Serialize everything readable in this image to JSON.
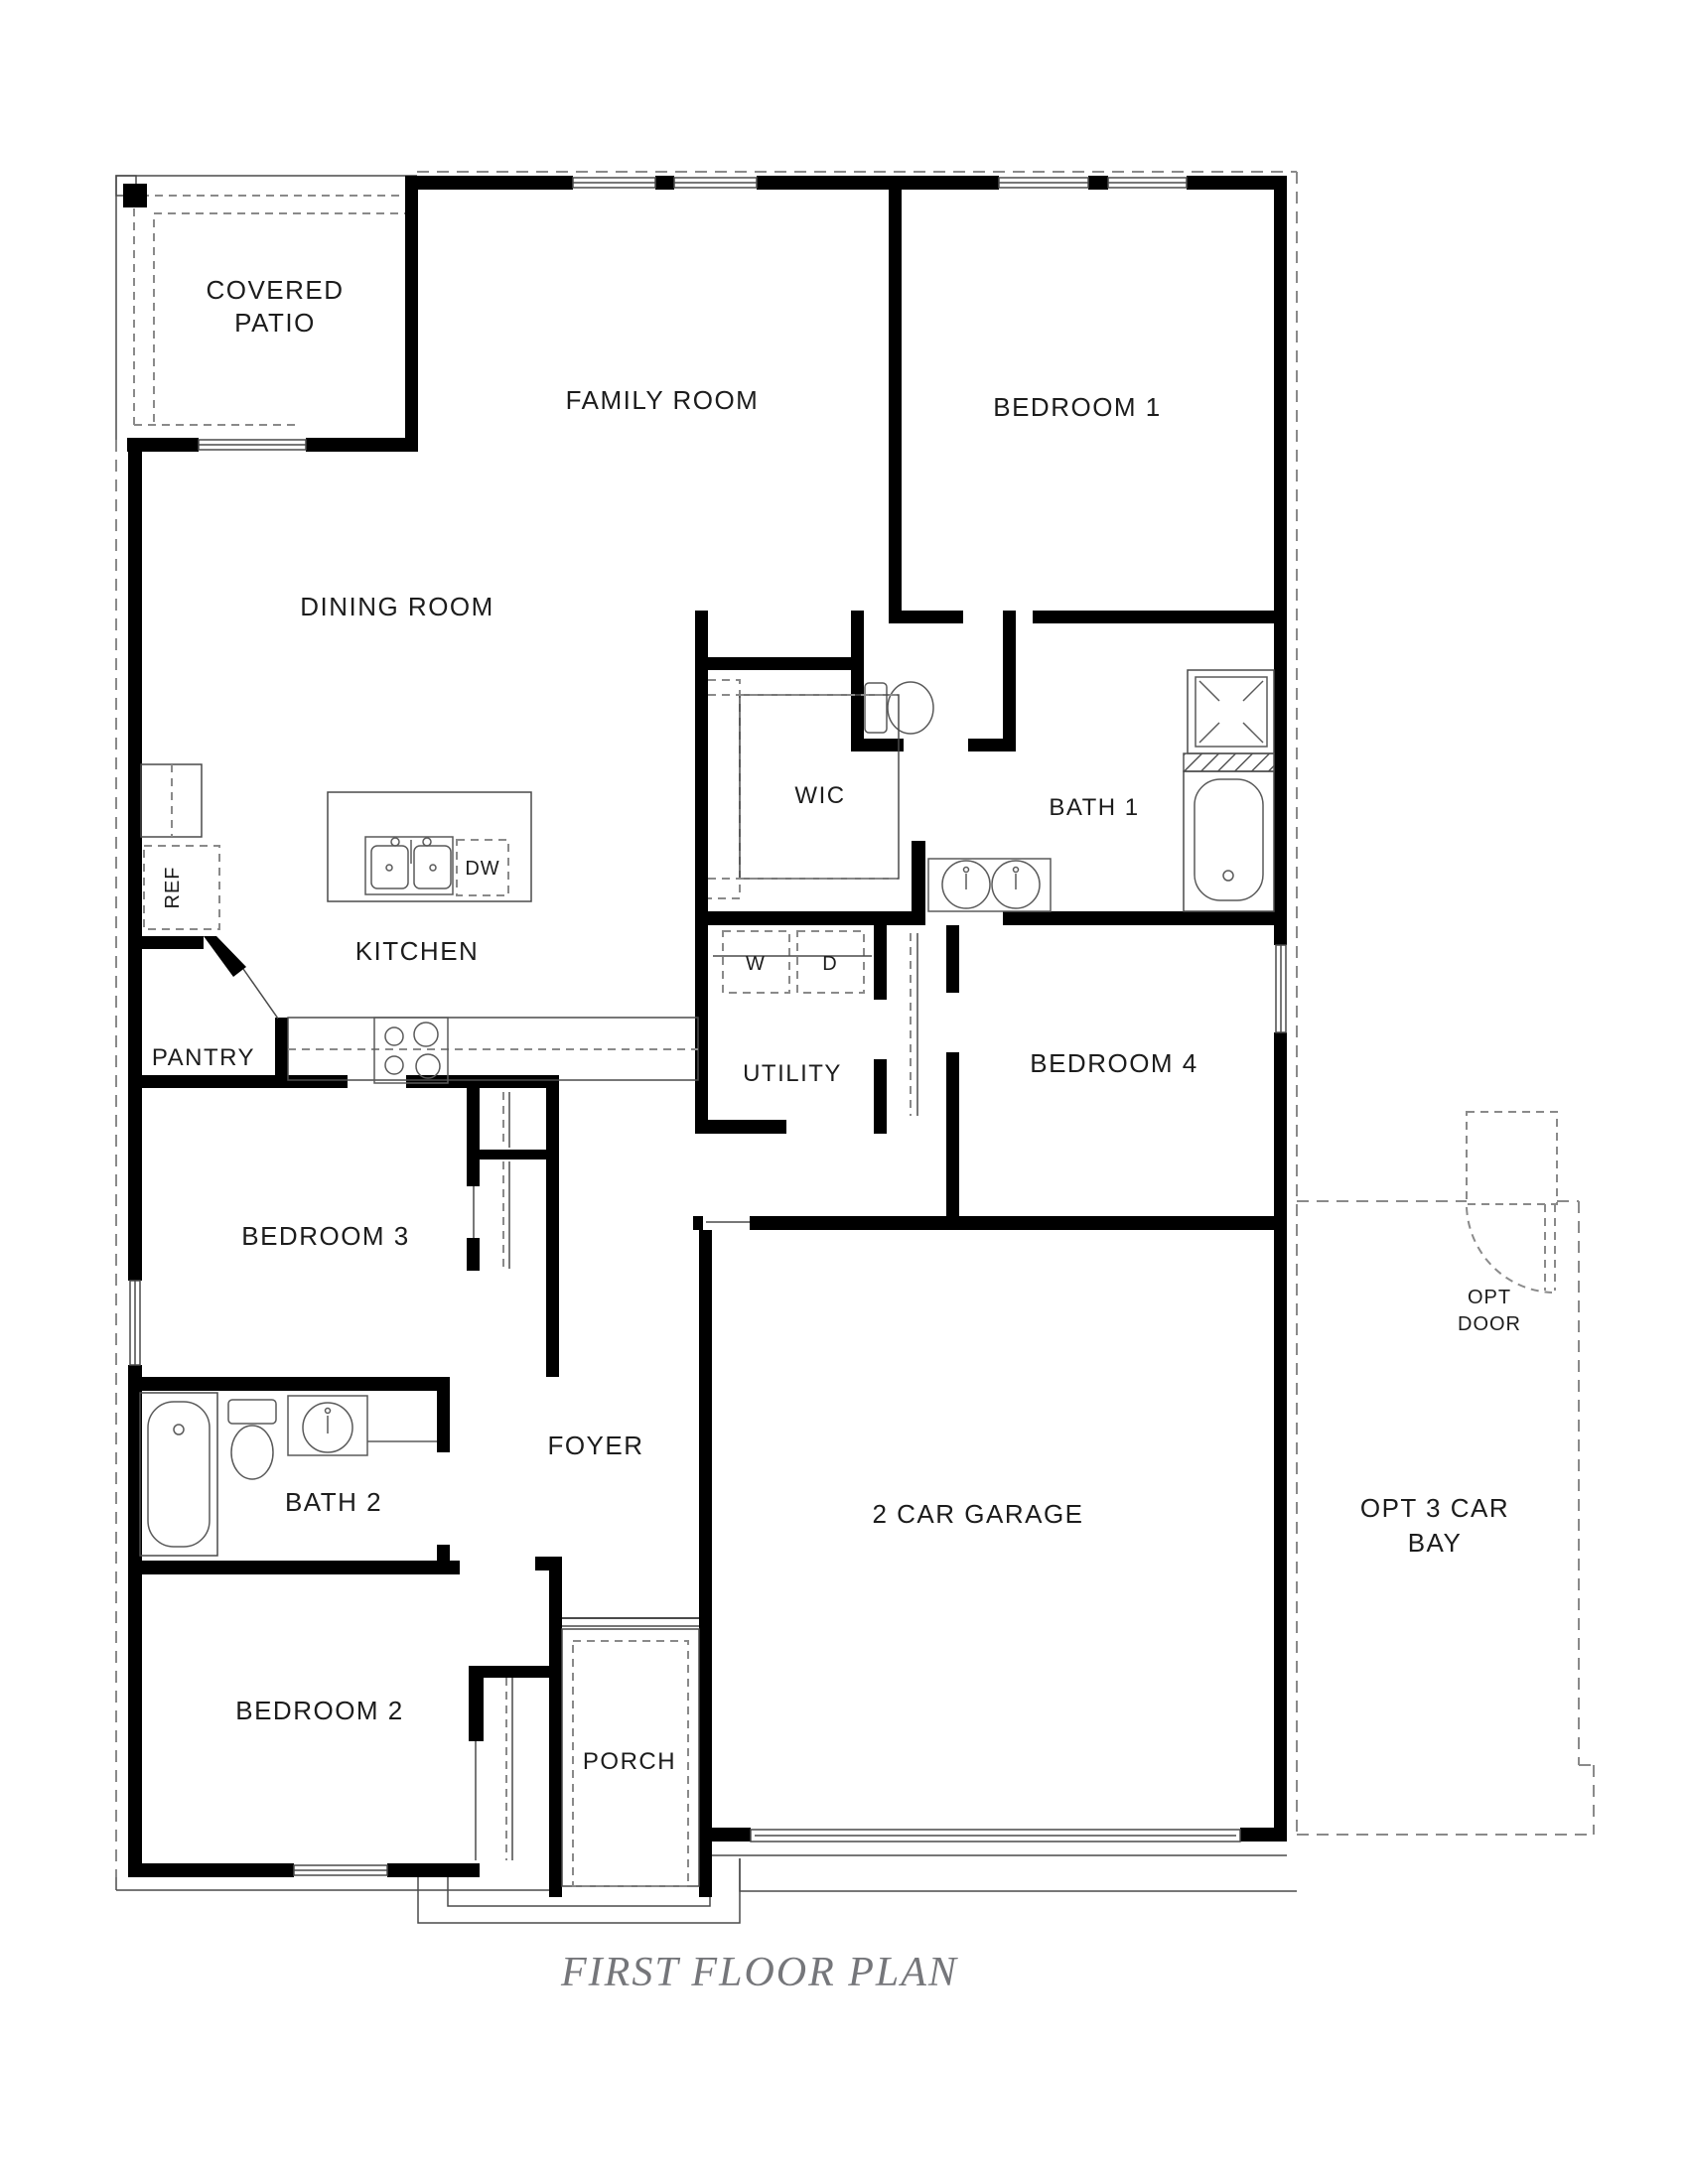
{
  "title": "FIRST FLOOR PLAN",
  "labels": {
    "covered_patio_1": "COVERED",
    "covered_patio_2": "PATIO",
    "family_room": "FAMILY ROOM",
    "bedroom1": "BEDROOM 1",
    "dining_room": "DINING ROOM",
    "wic": "WIC",
    "bath1": "BATH 1",
    "kitchen": "KITCHEN",
    "ref": "REF",
    "dw": "DW",
    "pantry": "PANTRY",
    "washer": "W",
    "dryer": "D",
    "utility": "UTILITY",
    "bedroom4": "BEDROOM 4",
    "bedroom3": "BEDROOM 3",
    "bath2": "BATH 2",
    "foyer": "FOYER",
    "garage": "2 CAR GARAGE",
    "bedroom2": "BEDROOM 2",
    "porch": "PORCH",
    "opt_door_1": "OPT",
    "opt_door_2": "DOOR",
    "opt_bay_1": "OPT 3 CAR",
    "opt_bay_2": "BAY"
  },
  "fixtures": [
    "toilet-icon",
    "bathtub-icon",
    "shower-icon",
    "vanity-sink-icon",
    "double-kitchen-sink-icon",
    "dishwasher-icon",
    "refrigerator-icon",
    "range-burners-icon",
    "washer-icon",
    "dryer-icon",
    "closet-rod-icon",
    "door-swing-icon",
    "window-icon",
    "garage-door-icon"
  ],
  "colors": {
    "wall": "#000000",
    "thin_line": "#4a4a4a",
    "dashed_line": "#8a8a8a",
    "label_text": "#1c1c1c",
    "title_text": "#75767a",
    "background": "#ffffff"
  }
}
